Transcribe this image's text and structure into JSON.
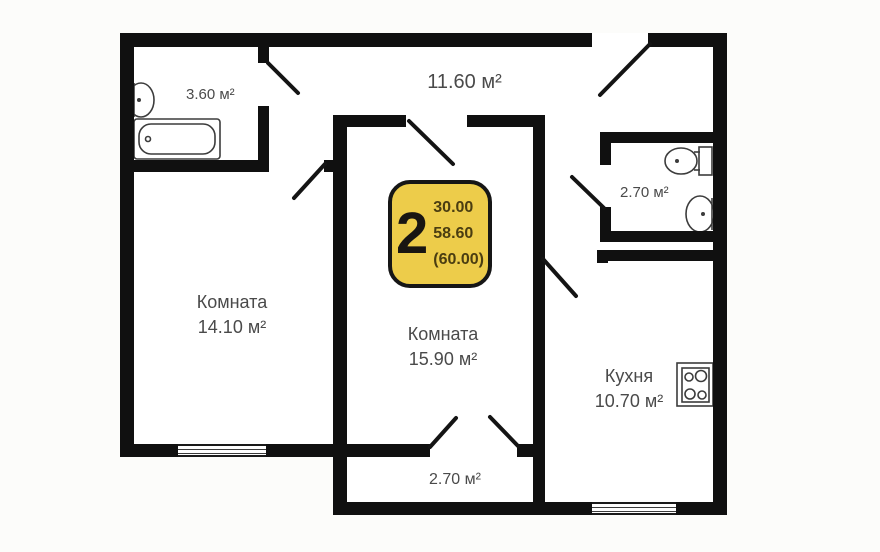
{
  "plan": {
    "badge": {
      "rooms_count": "2",
      "line1": "30.00",
      "line2": "58.60",
      "line3": "(60.00)"
    },
    "rooms": {
      "bathroom": {
        "area": "3.60 м²"
      },
      "hallway": {
        "area": "11.60 м²"
      },
      "wc": {
        "area": "2.70 м²"
      },
      "room1": {
        "name": "Комната",
        "area": "14.10 м²"
      },
      "room2": {
        "name": "Комната",
        "area": "15.90 м²"
      },
      "kitchen": {
        "name": "Кухня",
        "area": "10.70 м²"
      },
      "corridor": {
        "area": "2.70 м²"
      }
    },
    "fixtures": {
      "bathroom": [
        "sink-icon",
        "bathtub-icon"
      ],
      "wc": [
        "toilet-icon",
        "sink-icon"
      ],
      "kitchen": [
        "stove-icon"
      ]
    },
    "colors": {
      "wall": "#101010",
      "floor": "#ffffff",
      "background": "#fcfcfa",
      "badge_fill": "#edcc4a",
      "badge_border": "#161616",
      "badge_text": "#4a3d11",
      "label_text": "#4a4a4a"
    }
  }
}
